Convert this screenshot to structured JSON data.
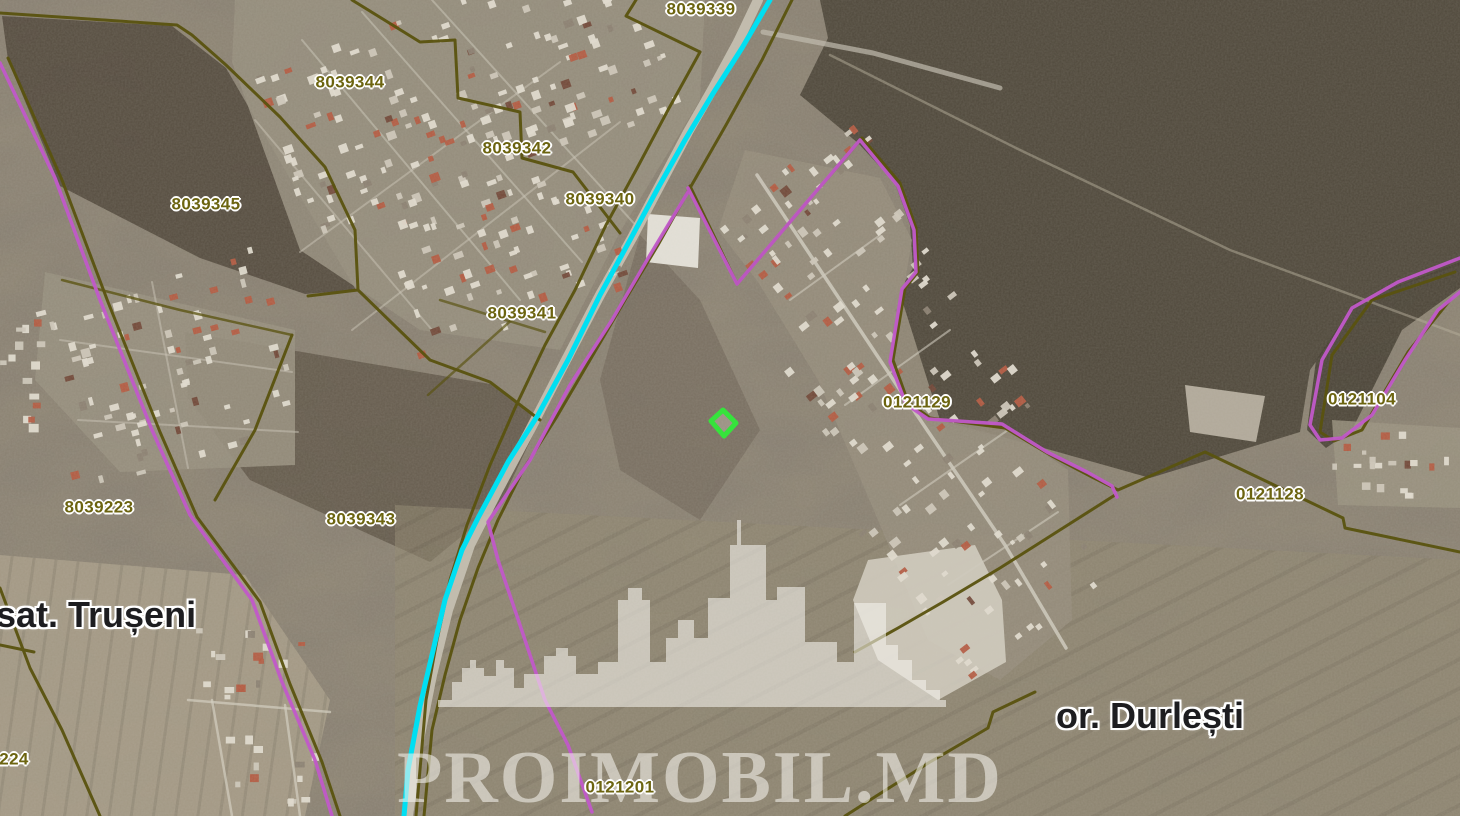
{
  "watermark": {
    "brand": "PROIMOBIL.MD",
    "icon": "city-skyline"
  },
  "parcel_labels": [
    {
      "id": "8039339",
      "x": 701,
      "y": 9
    },
    {
      "id": "8039344",
      "x": 350,
      "y": 82
    },
    {
      "id": "8039342",
      "x": 517,
      "y": 148
    },
    {
      "id": "8039340",
      "x": 600,
      "y": 199
    },
    {
      "id": "8039345",
      "x": 206,
      "y": 204
    },
    {
      "id": "8039341",
      "x": 522,
      "y": 313
    },
    {
      "id": "0121129",
      "x": 917,
      "y": 402
    },
    {
      "id": "0121104",
      "x": 1362,
      "y": 399
    },
    {
      "id": "0121128",
      "x": 1270,
      "y": 494
    },
    {
      "id": "8039223",
      "x": 99,
      "y": 507
    },
    {
      "id": "8039343",
      "x": 361,
      "y": 519
    },
    {
      "id": "0121201",
      "x": 620,
      "y": 787
    },
    {
      "id": "224",
      "x": 14,
      "y": 759
    }
  ],
  "place_labels": [
    {
      "text": "sat. Trușeni",
      "x": -4,
      "y": 615,
      "anchor": "left"
    },
    {
      "text": "or. Durlești",
      "x": 1150,
      "y": 716,
      "anchor": "center"
    }
  ],
  "highlighted_parcel": {
    "x": 723,
    "y": 423
  },
  "colors": {
    "route": "#00dff2",
    "boundary_primary": "#5a530f",
    "boundary_secondary": "#c158c9",
    "label_text": "#6c6410",
    "place_text": "#1d1d20",
    "highlight": "#36e33c",
    "watermark": "#f5f3ed"
  }
}
